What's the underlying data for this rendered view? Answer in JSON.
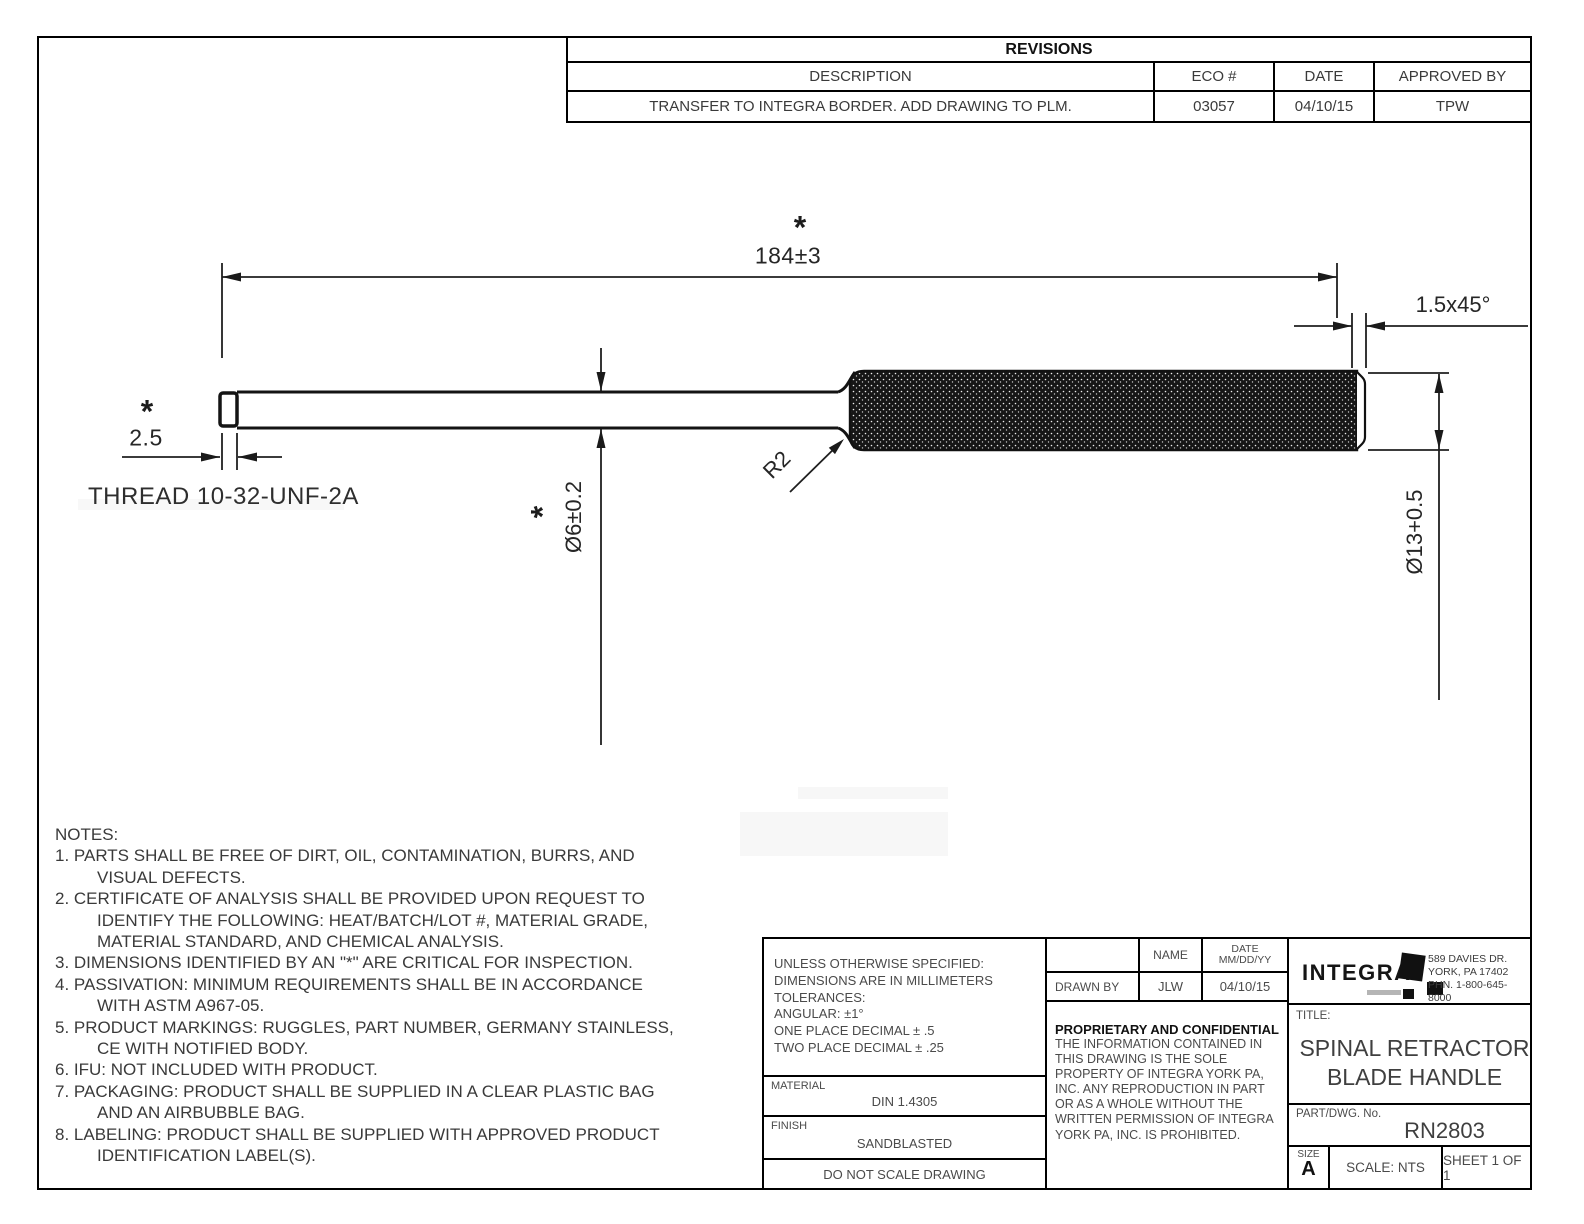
{
  "revisions": {
    "title": "REVISIONS",
    "columns": {
      "description": "DESCRIPTION",
      "eco": "ECO #",
      "date": "DATE",
      "approved": "APPROVED BY"
    },
    "row": {
      "description": "TRANSFER TO INTEGRA BORDER. ADD DRAWING TO PLM.",
      "eco": "03057",
      "date": "04/10/15",
      "approved": "TPW"
    }
  },
  "drawing": {
    "critical_marker": "*",
    "dims": {
      "overall_length": "184±3",
      "chamfer": "1.5x45°",
      "thread_length": "2.5",
      "thread_label": "THREAD 10-32-UNF-2A",
      "shaft_diameter": "Ø6±0.2",
      "handle_diameter": "Ø13+0.5",
      "fillet_radius": "R2"
    }
  },
  "notes": {
    "lines": [
      "NOTES:",
      "1.  PARTS SHALL BE FREE OF DIRT, OIL, CONTAMINATION, BURRS, AND",
      "VISUAL DEFECTS.",
      "2.  CERTIFICATE OF ANALYSIS SHALL BE PROVIDED UPON REQUEST TO",
      "IDENTIFY THE FOLLOWING: HEAT/BATCH/LOT #, MATERIAL GRADE,",
      "MATERIAL STANDARD, AND CHEMICAL ANALYSIS.",
      "3.  DIMENSIONS IDENTIFIED BY AN \"*\" ARE CRITICAL FOR INSPECTION.",
      "4.  PASSIVATION: MINIMUM REQUIREMENTS SHALL BE IN ACCORDANCE",
      "WITH ASTM A967-05.",
      "5.  PRODUCT MARKINGS: RUGGLES, PART NUMBER, GERMANY STAINLESS,",
      "CE WITH NOTIFIED BODY.",
      "6.  IFU: NOT INCLUDED WITH PRODUCT.",
      "7.  PACKAGING: PRODUCT SHALL BE SUPPLIED IN A CLEAR PLASTIC BAG",
      "AND AN AIRBUBBLE BAG.",
      "8.  LABELING: PRODUCT SHALL BE SUPPLIED WITH APPROVED PRODUCT",
      "IDENTIFICATION LABEL(S)."
    ]
  },
  "titleblock": {
    "tolerances": "UNLESS OTHERWISE SPECIFIED:\nDIMENSIONS ARE IN MILLIMETERS\nTOLERANCES:\nANGULAR: ±1°\nONE PLACE DECIMAL ± .5\nTWO PLACE DECIMAL ± .25",
    "material_label": "MATERIAL",
    "material": "DIN 1.4305",
    "finish_label": "FINISH",
    "finish": "SANDBLASTED",
    "no_scale": "DO NOT SCALE DRAWING",
    "name_col": "NAME",
    "date_col": "DATE\nMM/DD/YY",
    "drawn_by_label": "DRAWN BY",
    "drawn_by_name": "JLW",
    "drawn_by_date": "04/10/15",
    "proprietary_title": "PROPRIETARY AND CONFIDENTIAL",
    "proprietary_body": "THE INFORMATION CONTAINED IN\nTHIS DRAWING IS THE SOLE\nPROPERTY OF INTEGRA YORK PA,\nINC.  ANY REPRODUCTION IN PART\nOR AS A WHOLE WITHOUT THE\nWRITTEN PERMISSION OF INTEGRA\nYORK PA, INC. IS PROHIBITED.",
    "company_name": "INTEGRA.",
    "company_address": "589 DAVIES DR.\nYORK, PA 17402\nPHN. 1-800-645-8000",
    "title_label": "TITLE:",
    "title": "SPINAL RETRACTOR\nBLADE HANDLE",
    "part_label": "PART/DWG. No.",
    "part_number": "RN2803",
    "size_label": "SIZE",
    "size": "A",
    "scale": "SCALE: NTS",
    "sheet": "SHEET 1 OF 1"
  }
}
